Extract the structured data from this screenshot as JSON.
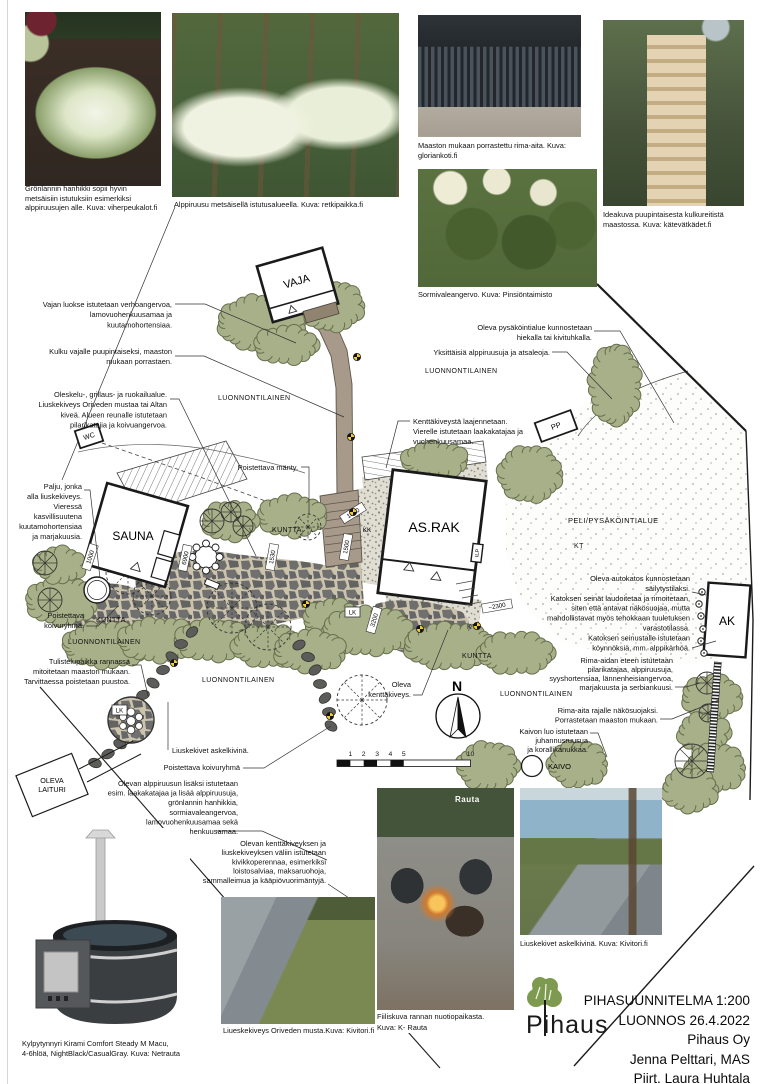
{
  "photos": {
    "hanhikki": {
      "caption_lines": [
        "Grönlannin hanhikki sopii hyvin",
        "metsäisiin istutuksiin esimerkiksi",
        "alppiruusujen alle. Kuva: viherpeukalot.fi"
      ]
    },
    "alppiruusu": {
      "caption": "Alppiruusu metsäisellä istutusalueella. Kuva: retkipaikka.fi"
    },
    "rima_aita": {
      "caption_lines": [
        "Maaston mukaan porrastettu rima-aita. Kuva:",
        "gloriankoti.fi"
      ]
    },
    "sormivaleangervo": {
      "caption": "Sormivaleangervo. Kuva: Pinsiöntaimisto"
    },
    "portaat": {
      "caption_lines": [
        "Ideakuva puupintaisesta kulkureitistä",
        "maastossa. Kuva: kätevätkädet.fi"
      ]
    },
    "kylpytynnyri": {
      "caption_lines": [
        "Kylpytynnyri Kirami Comfort Steady M Macu,",
        "4-6hlöä, NightBlack/CasualGray. Kuva: Netrauta"
      ]
    },
    "liuskekiveys_musta": {
      "caption": "Liueskekiveys Oriveden musta.Kuva: Kivitori.fi"
    },
    "nuotiopaikka": {
      "caption_lines": [
        "Fiiliskuva rannan nuotiopaikasta.",
        "Kuva: K- Rauta"
      ],
      "watermark": "Rauta"
    },
    "askelkivet": {
      "caption": "Liuskekivet askelkivinä. Kuva: Kivitori.fi"
    }
  },
  "plan": {
    "buildings": {
      "vaja": "VAJA",
      "sauna": "SAUNA",
      "asrak": "AS.RAK",
      "ak": "AK",
      "wc": "WC",
      "pp": "PP",
      "ilp": "ILP",
      "laituri_line1": "OLEVA",
      "laituri_line2": "LAITURI",
      "kaivo": "KAIVO"
    },
    "labels": {
      "luonnontilainen": "LUONNONTILAINEN",
      "kuntta": "KUNTTA",
      "kt": "KT",
      "peli": "PELI/PYSÄKÖINTIALUE",
      "lk": "LK",
      "kk": "KK",
      "north": "N"
    },
    "dimensions": {
      "a1000": "1000",
      "a6900": "6900",
      "a1530": "1530",
      "b1000": "1000",
      "a1500": "1500",
      "a3200": "3200",
      "a2300": "~2300"
    },
    "scalebar": {
      "t1": "1",
      "t2": "2",
      "t3": "3",
      "t4": "4",
      "t5": "5",
      "t10": "10"
    },
    "annotations": {
      "vaja": [
        "Vajan luokse istutetaan verhoangervoa,",
        "lamovuohenkuusamaa ja",
        "kuutamohortensiaa."
      ],
      "kulku": [
        "Kulku vajalle puupintaiseksi, maaston",
        "mukaan porrastaen."
      ],
      "oleskelu": [
        "Oleskelu-, grillaus- ja ruokailualue.",
        "Liuskekiveys Oriveden mustaa tai Altan",
        "kiveä.  Alueen reunalle istutetaan",
        "pilarikatajia ja koivuangervoa."
      ],
      "palju": [
        "Palju, jonka",
        "alla liuskekiveys.",
        "Vieressä",
        "kasvillisuutena",
        "kuutamohortensiaa",
        "ja marjakuusia."
      ],
      "pk1": [
        "Poistettava",
        "koivuryhmä."
      ],
      "tulistelu": [
        "Tulistelupaikka rannassa",
        "mitoitetaan maaston mukaan.",
        "Tarvittaessa poistetaan puustoa."
      ],
      "askel": [
        "Liuskekivet askelkivinä."
      ],
      "pk2": [
        "Poistettava koivuryhmä"
      ],
      "alppiruusun": [
        "Olevan alppiruusun lisäksi istutetaan",
        "esim. laakakatajaa ja lisää alppiruusuja,",
        "grönlannin hanhikkia,",
        "sormiavaleangervoa,",
        "lamovuohenkuusamaa sekä",
        "rusovuohenkuusamaa."
      ],
      "kenttaliusk": [
        "Olevan kenttäkiveyksen ja",
        "liuskekiveyksen väliin istutetaan",
        "kivikkoperennaa, esimerkiksi",
        "loistosalviaa, maksaruohoja,",
        "sammalleimua ja kääpiövuorimäntyjä."
      ],
      "manty": [
        "Poistettava mänty."
      ],
      "olevakentta": [
        "Oleva",
        "kenttäkiveys."
      ],
      "pysak": [
        "Oleva pysäköintialue kunnostetaan",
        "hiekalla tai kivituhkalla."
      ],
      "yksittaisia": [
        "Yksittäisiä alppiruusuja ja atsaleoja."
      ],
      "kenttalaajennus": [
        "Kenttäkiveystä laajennetaan.",
        "Vierelle istutetaan laakakatajaa ja",
        "vuohenkuusamaa."
      ],
      "autokatos": [
        "Oleva autokatos kunnostetaan",
        "säilytystilaksi.",
        "Katoksen seinät laudoitetaa ja rimoitetaan,",
        "siten että antavat näkösuojaa, mutta",
        "mahdollistavat myös tehokkaan tuuletuksen",
        "varastotilassa.",
        "Katoksen seinustalle istutetaan",
        "köynnöksiä, mm. alppikärhöä."
      ],
      "rimaeteen": [
        "Rima-aidan eteen istutetaan",
        "pilarikatajaa, alppiruusuja,",
        "syyshortensiaa, lännenheisiangervoa,",
        "marjakuusta ja serbiankuusi."
      ],
      "rimarajalle": [
        "Rima-aita rajalle näkösuojaksi.",
        "Porrastetaan maaston mukaan."
      ],
      "kaivonluo": [
        "Kaivon luo istutetaan",
        "juhannusruusua",
        "ja korallikanukkaa."
      ]
    }
  },
  "title_block": {
    "logo_text": "Pihaus",
    "lines": [
      "PIHASUUNNITELMA 1:200",
      "LUONNOS 26.4.2022",
      "Pihaus Oy",
      "Jenna Pelttari, MAS",
      "Piirt. Laura Huhtala"
    ]
  }
}
